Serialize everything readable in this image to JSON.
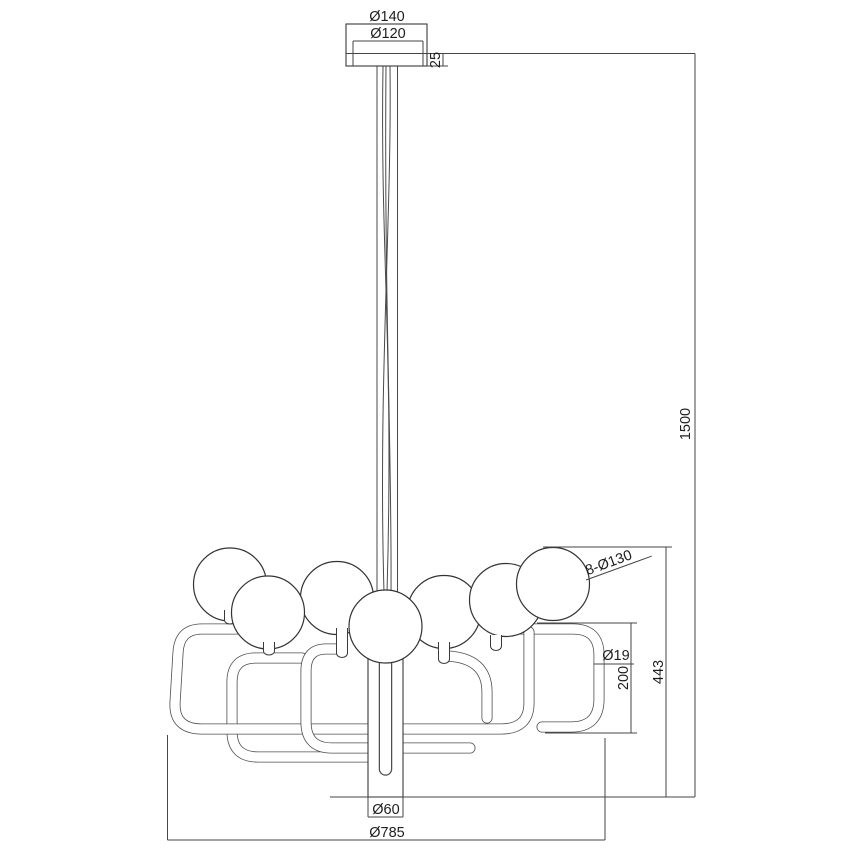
{
  "drawing": {
    "kind": "technical-dimension-drawing",
    "subject": "8-globe chandelier pendant",
    "background_color": "#ffffff",
    "line_color": "#3a3a3a",
    "labels": {
      "canopy_outer": "Ø140",
      "canopy_inner": "Ø120",
      "canopy_height": "25",
      "drop_height": "1500",
      "globes": "8-Ø130",
      "tube": "Ø19",
      "arm_height": "200",
      "fixture_height": "443",
      "stem": "Ø60",
      "fixture_width": "Ø785"
    }
  }
}
